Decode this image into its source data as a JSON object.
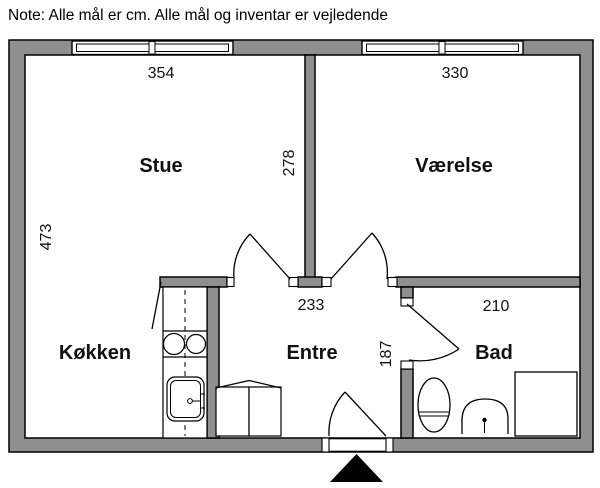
{
  "note": "Note: Alle mål er cm. Alle mål og inventar er vejledende",
  "plan": {
    "labels": {
      "stue": "Stue",
      "vaerelse": "Værelse",
      "koekken": "Køkken",
      "entre": "Entre",
      "bad": "Bad"
    },
    "dims": {
      "stue_width": "354",
      "vaerelse_width": "330",
      "stue_height": "473",
      "partition_height": "278",
      "entre_width": "233",
      "entre_height": "187",
      "bad_width": "210"
    },
    "colors": {
      "wall_fill": "#8f8f8f",
      "outline": "#000000",
      "background": "#ffffff",
      "entrance_arrow": "#000000"
    },
    "icons": {
      "entrance_arrow": "entrance-arrow"
    }
  }
}
